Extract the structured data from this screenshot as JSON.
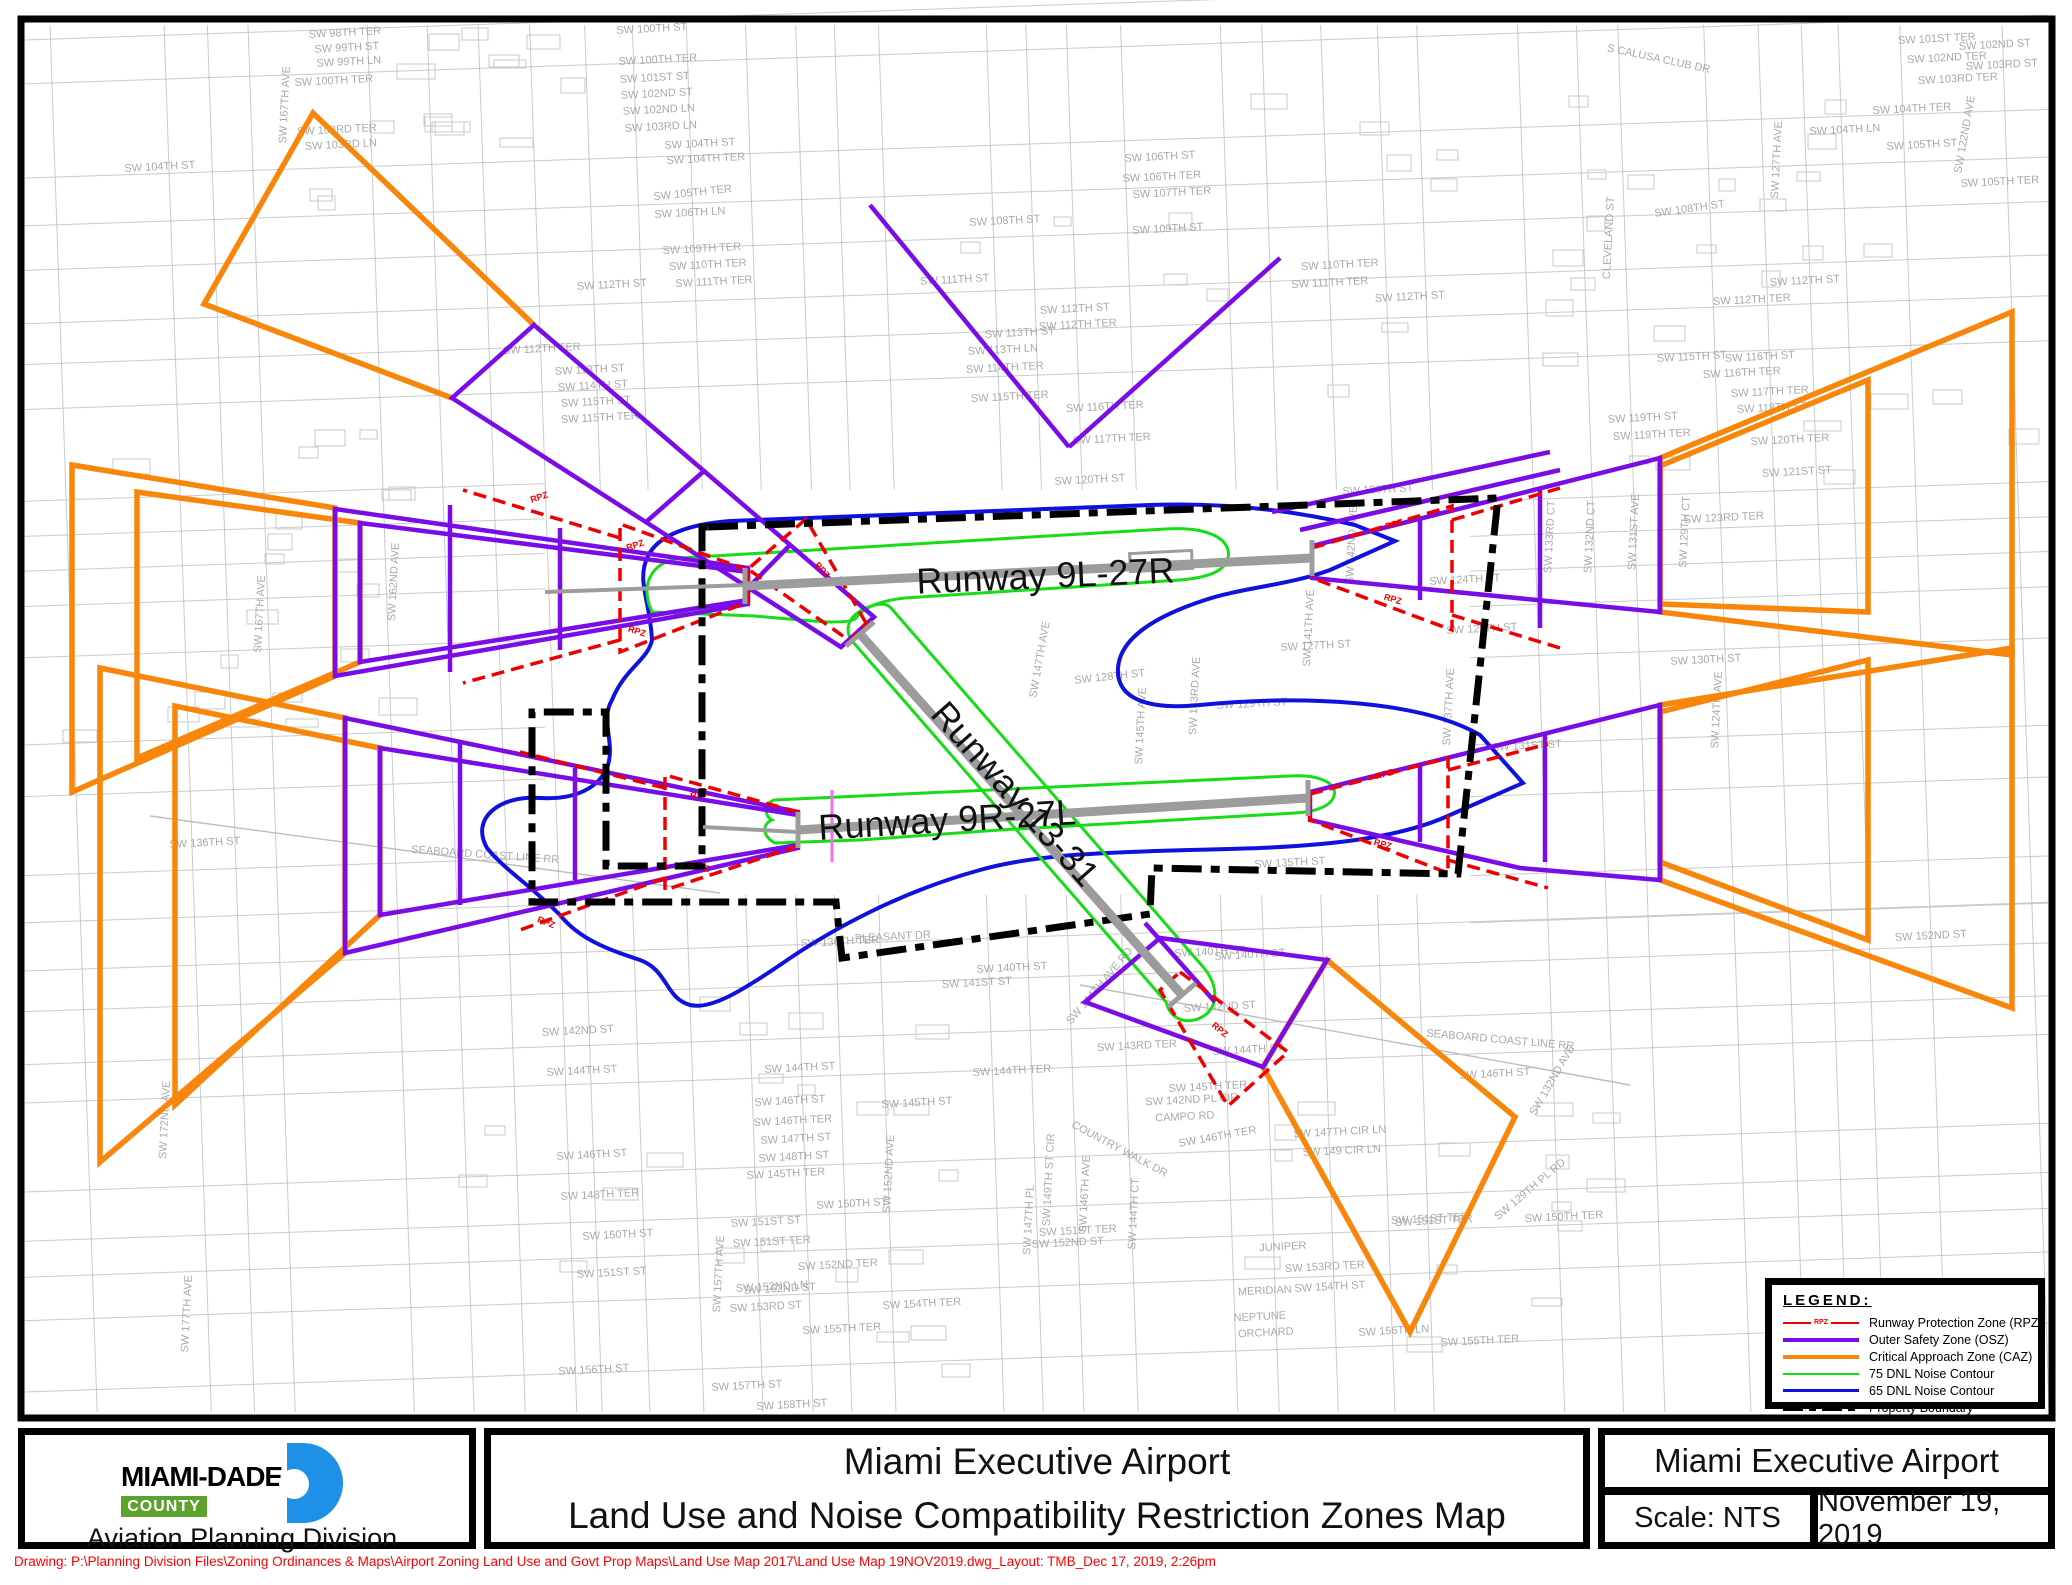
{
  "colors": {
    "rpz": "#EE0000",
    "osz": "#7A0CE8",
    "caz": "#F8860B",
    "dnl75": "#17DD17",
    "dnl65": "#1111DF",
    "boundary": "#000000",
    "runway": "#9C9C9C",
    "street": "#BDBDBD",
    "street_label": "#A9A9A9",
    "logo_blue": "#1E90E8",
    "county_green": "#5EA22E",
    "note_red": "#FF0000"
  },
  "legend": {
    "title": "LEGEND:",
    "items": [
      {
        "label": "Runway Protection Zone (RPZ)",
        "tag": "RPZ"
      },
      {
        "label": "Outer Safety Zone (OSZ)"
      },
      {
        "label": "Critical Approach Zone (CAZ)"
      },
      {
        "label": "75 DNL Noise Contour"
      },
      {
        "label": "65 DNL Noise Contour"
      },
      {
        "label": "Property Boundary"
      }
    ]
  },
  "title_block": {
    "agency": {
      "name": "MIAMI-DADE",
      "county": "COUNTY",
      "division": "Aviation Planning Division"
    },
    "main": {
      "line1": "Miami Executive Airport",
      "line2": "Land Use and Noise Compatibility Restriction Zones Map"
    },
    "right": {
      "airport": "Miami Executive Airport",
      "scale": "Scale: NTS",
      "date": "November 19, 2019"
    }
  },
  "footer_note": "Drawing: P:\\Planning Division Files\\Zoning Ordinances & Maps\\Airport Zoning Land Use and Govt Prop Maps\\Land Use Map 2017\\Land Use Map 19NOV2019.dwg_Layout: TMB_Dec 17,  2019, 2:26pm",
  "map": {
    "rpz_tag": "RPZ",
    "runways": [
      {
        "id": "9L-27R",
        "label": "Runway 9L-27R",
        "x": 1046,
        "y": 588,
        "rot": -2.5,
        "size": 36
      },
      {
        "id": "13-31",
        "label": "Runway 13-31",
        "x": 1006,
        "y": 802,
        "rot": 48.5,
        "size": 36
      },
      {
        "id": "9R-27L",
        "label": "Runway 9R-27L",
        "x": 948,
        "y": 832,
        "rot": -3.5,
        "size": 36
      }
    ],
    "street_labels": [
      [
        "SW 98TH TER",
        345,
        36,
        -3
      ],
      [
        "SW 99TH ST",
        347,
        51,
        -3
      ],
      [
        "SW 99TH LN",
        349,
        65,
        -3
      ],
      [
        "SW 100TH TER",
        334,
        84,
        -3
      ],
      [
        "SW 103RD TER",
        337,
        133,
        -3
      ],
      [
        "SW 103RD LN",
        341,
        148,
        -3
      ],
      [
        "SW 104TH ST",
        160,
        170,
        -3
      ],
      [
        "SW 167TH AVE",
        288,
        105,
        -87
      ],
      [
        "SW 100TH ST",
        652,
        32,
        -3
      ],
      [
        "SW 100TH TER",
        658,
        63,
        -3
      ],
      [
        "SW 101ST ST",
        655,
        81,
        -3
      ],
      [
        "SW 102ND ST",
        657,
        97,
        -3
      ],
      [
        "SW 102ND LN",
        659,
        113,
        -3
      ],
      [
        "SW 103RD LN",
        661,
        130,
        -3
      ],
      [
        "SW 104TH ST",
        700,
        147,
        -3
      ],
      [
        "SW 104TH TER",
        706,
        162,
        -3
      ],
      [
        "SW 105TH TER",
        693,
        196,
        -6
      ],
      [
        "SW 106TH LN",
        690,
        216,
        -3
      ],
      [
        "SW 109TH TER",
        702,
        252,
        -3
      ],
      [
        "SW 110TH TER",
        708,
        268,
        -3
      ],
      [
        "SW 111TH TER",
        714,
        285,
        -3
      ],
      [
        "SW 112TH ST",
        612,
        288,
        -3
      ],
      [
        "SW 112TH TER",
        542,
        352,
        -3
      ],
      [
        "SW 113TH ST",
        590,
        373,
        -3
      ],
      [
        "SW 114TH ST",
        593,
        389,
        -3
      ],
      [
        "SW 115TH ST",
        596,
        405,
        -3
      ],
      [
        "SW 115TH TER",
        600,
        421,
        -3
      ],
      [
        "SW 106TH ST",
        1160,
        160,
        -3
      ],
      [
        "SW 106TH TER",
        1162,
        180,
        -3
      ],
      [
        "SW 107TH TER",
        1172,
        196,
        -3
      ],
      [
        "SW 108TH ST",
        1005,
        224,
        -3
      ],
      [
        "SW 109TH ST",
        1168,
        232,
        -3
      ],
      [
        "SW 111TH ST",
        955,
        283,
        -3
      ],
      [
        "SW 112TH ST",
        1075,
        312,
        -3
      ],
      [
        "SW 112TH TER",
        1078,
        328,
        -3
      ],
      [
        "SW 113TH ST",
        1020,
        336,
        -3
      ],
      [
        "SW 113TH LN",
        1003,
        353,
        -3
      ],
      [
        "SW 114TH TER",
        1005,
        371,
        -3
      ],
      [
        "SW 115TH TER",
        1010,
        400,
        -3
      ],
      [
        "SW 116TH TER",
        1105,
        410,
        -3
      ],
      [
        "SW 117TH TER",
        1112,
        442,
        -3
      ],
      [
        "SW 111TH TER",
        1330,
        286,
        -3
      ],
      [
        "SW 112TH ST",
        1410,
        300,
        -3
      ],
      [
        "SW 110TH TER",
        1340,
        268,
        -3
      ],
      [
        "S CALUSA CLUB DR",
        1658,
        62,
        12
      ],
      [
        "SW 101ST TER",
        1937,
        42,
        -3
      ],
      [
        "SW 102ND ST",
        1995,
        48,
        -3
      ],
      [
        "SW 102ND TER",
        1947,
        61,
        -3
      ],
      [
        "SW 103RD ST",
        2002,
        68,
        -3
      ],
      [
        "SW 103RD TER",
        1958,
        82,
        -3
      ],
      [
        "SW 104TH TER",
        1912,
        112,
        -3
      ],
      [
        "SW 104TH LN",
        1845,
        133,
        -3
      ],
      [
        "SW 105TH ST",
        1922,
        148,
        -3
      ],
      [
        "SW 105TH TER",
        2000,
        185,
        -3
      ],
      [
        "SW 108TH ST",
        1690,
        212,
        -8
      ],
      [
        "SW 112TH ST",
        1805,
        284,
        -3
      ],
      [
        "SW 112TH TER",
        1752,
        303,
        -3
      ],
      [
        "SW 122ND AVE",
        1968,
        135,
        -80
      ],
      [
        "SW 127TH AVE",
        1780,
        160,
        -87
      ],
      [
        "CLEVELAND ST",
        1612,
        238,
        -87
      ],
      [
        "SW 115TH ST",
        1692,
        360,
        -3
      ],
      [
        "SW 116TH ST",
        1760,
        360,
        -3
      ],
      [
        "SW 116TH TER",
        1742,
        376,
        -3
      ],
      [
        "SW 117TH TER",
        1770,
        395,
        -3
      ],
      [
        "SW 118TH ST",
        1772,
        411,
        -3
      ],
      [
        "SW 119TH ST",
        1643,
        421,
        -3
      ],
      [
        "SW 119TH TER",
        1652,
        438,
        -3
      ],
      [
        "SW 120TH TER",
        1790,
        443,
        -3
      ],
      [
        "SW 121ST ST",
        1797,
        475,
        -3
      ],
      [
        "SW 123RD TER",
        1724,
        521,
        -3
      ],
      [
        "SW 120TH ST",
        1378,
        493,
        -3
      ],
      [
        "SW 120TH ST",
        1090,
        483,
        -3
      ],
      [
        "SW 124TH ST",
        1465,
        583,
        -3
      ],
      [
        "SW 125TH ST",
        1482,
        632,
        -3
      ],
      [
        "SW 127TH ST",
        1316,
        649,
        -3
      ],
      [
        "SW 128TH ST",
        1110,
        680,
        -6
      ],
      [
        "SW 129TH ST",
        1252,
        707,
        -3
      ],
      [
        "SW 130TH ST",
        1706,
        663,
        -3
      ],
      [
        "SW 131ST ST",
        1527,
        749,
        -3
      ],
      [
        "SW 133RD CT",
        1553,
        537,
        -87
      ],
      [
        "SW 132ND CT",
        1593,
        537,
        -87
      ],
      [
        "SW 131ST AVE",
        1637,
        532,
        -87
      ],
      [
        "SW 129TH CT",
        1688,
        532,
        -87
      ],
      [
        "SW 142ND AVE",
        1355,
        545,
        -87
      ],
      [
        "SW 141TH AVE",
        1312,
        628,
        -87
      ],
      [
        "SW 147TH AVE",
        1043,
        660,
        -80
      ],
      [
        "SW 145TH AVE",
        1144,
        726,
        -87
      ],
      [
        "SW 143RD AVE",
        1198,
        696,
        -87
      ],
      [
        "SW 124TH AVE",
        1720,
        710,
        -87
      ],
      [
        "SW 137TH AVE",
        1452,
        707,
        -87
      ],
      [
        "SW 162ND AVE",
        397,
        582,
        -87
      ],
      [
        "SW 167TH AVE",
        263,
        614,
        -87
      ],
      [
        "SW 135TH ST",
        1290,
        866,
        -3
      ],
      [
        "SW 136TH ST",
        205,
        846,
        -3
      ],
      [
        "SEABOARD COAST LINE RR",
        485,
        858,
        4
      ],
      [
        "SEABOARD COAST LINE RR",
        1500,
        1043,
        5
      ],
      [
        "SW 136TH TER",
        840,
        945,
        -3
      ],
      [
        "PLEASANT DR",
        893,
        940,
        -3
      ],
      [
        "SW 140TH ST",
        1012,
        971,
        -3
      ],
      [
        "SW 141ST ST",
        977,
        986,
        -3
      ],
      [
        "SW 140TH ST",
        1250,
        958,
        -3
      ],
      [
        "SW 142ND ST",
        1220,
        1010,
        -3
      ],
      [
        "SW 143RD TER",
        1137,
        1049,
        -3
      ],
      [
        "SW 144TH ST",
        800,
        1071,
        -3
      ],
      [
        "SW 144TH TER",
        1012,
        1074,
        -3
      ],
      [
        "SW 144TH ST",
        1248,
        1053,
        -3
      ],
      [
        "SW 145TH ST",
        917,
        1106,
        -3
      ],
      [
        "SW 146TH ST",
        790,
        1104,
        -3
      ],
      [
        "SW 146TH TER",
        793,
        1124,
        -3
      ],
      [
        "SW 147TH ST",
        796,
        1142,
        -3
      ],
      [
        "SW 148TH ST",
        794,
        1160,
        -3
      ],
      [
        "SW 145TH TER",
        786,
        1177,
        -3
      ],
      [
        "SW 145TH TER",
        1208,
        1090,
        -3
      ],
      [
        "SW 142ND PL CIR",
        1192,
        1103,
        -3
      ],
      [
        "CAMPO RD",
        1185,
        1120,
        -3
      ],
      [
        "COUNTRY WALK DR",
        1118,
        1152,
        28
      ],
      [
        "SW 146TH TER",
        1218,
        1140,
        -10
      ],
      [
        "SW 147TH CIR LN",
        1340,
        1135,
        -3
      ],
      [
        "SW 149 CIR LN",
        1342,
        1154,
        -3
      ],
      [
        "SW 150TH ST",
        852,
        1207,
        -3
      ],
      [
        "SW 151ST ST",
        766,
        1225,
        -3
      ],
      [
        "SW 151ST TER",
        772,
        1245,
        -3
      ],
      [
        "SW 151ST TER",
        1078,
        1234,
        -3
      ],
      [
        "SW 152ND ST",
        1068,
        1246,
        -3
      ],
      [
        "SW 152ND TER",
        838,
        1268,
        -3
      ],
      [
        "SW 152ND LN",
        772,
        1290,
        -3
      ],
      [
        "SW 153RD ST",
        766,
        1310,
        -3
      ],
      [
        "SW 154TH TER",
        922,
        1307,
        -3
      ],
      [
        "SW 155TH TER",
        842,
        1332,
        -3
      ],
      [
        "SW 153RD TER",
        1325,
        1270,
        -3
      ],
      [
        "SW 154TH ST",
        1330,
        1290,
        -3
      ],
      [
        "JUNIPER",
        1283,
        1250,
        -3
      ],
      [
        "MERIDIAN",
        1265,
        1294,
        -3
      ],
      [
        "NEPTUNE",
        1260,
        1320,
        -3
      ],
      [
        "ORCHARD",
        1266,
        1336,
        -3
      ],
      [
        "SW 156TH LN",
        1394,
        1334,
        -3
      ],
      [
        "SW 155TH TER",
        1480,
        1344,
        -3
      ],
      [
        "SW 156TH ST",
        594,
        1373,
        -3
      ],
      [
        "SW 157TH ST",
        747,
        1389,
        -3
      ],
      [
        "SW 158TH ST",
        792,
        1408,
        -3
      ],
      [
        "SW 151ST TER",
        1434,
        1224,
        -3
      ],
      [
        "SW 150TH TER",
        1564,
        1220,
        -3
      ],
      [
        "SW 152ND ST",
        1931,
        939,
        -3
      ],
      [
        "SW 140TH ST",
        1210,
        955,
        -3
      ],
      [
        "SW 152ND AVE",
        892,
        1174,
        -87
      ],
      [
        "SW 149TH ST CIR",
        1052,
        1180,
        -87
      ],
      [
        "SW 147TH PL",
        1032,
        1220,
        -87
      ],
      [
        "SW 144TH CT",
        1137,
        1214,
        -87
      ],
      [
        "SW 144TH AVE RD",
        1102,
        988,
        -50
      ],
      [
        "SW 146TH AVE",
        1088,
        1194,
        -87
      ],
      [
        "SW 157TH AVE",
        722,
        1274,
        -87
      ],
      [
        "SW 172ND AVE",
        168,
        1120,
        -87
      ],
      [
        "SW 177TH AVE",
        190,
        1314,
        -87
      ],
      [
        "SW 129TH PL RD",
        1532,
        1192,
        -40
      ],
      [
        "SW 132ND AVE",
        1555,
        1082,
        -60
      ],
      [
        "SW 146TH ST",
        1495,
        1077,
        -3
      ],
      [
        "SW 151ST TER",
        1430,
        1222,
        -3
      ],
      [
        "SW 144TH ST",
        582,
        1074,
        -3
      ],
      [
        "SW 142ND ST",
        578,
        1034,
        -3
      ],
      [
        "SW 146TH ST",
        592,
        1158,
        -3
      ],
      [
        "SW 148TH TER",
        600,
        1198,
        -3
      ],
      [
        "SW 150TH ST",
        618,
        1238,
        -3
      ],
      [
        "SW 151ST ST",
        612,
        1276,
        -3
      ],
      [
        "SW 152ND ST",
        780,
        1292,
        -3
      ]
    ]
  }
}
